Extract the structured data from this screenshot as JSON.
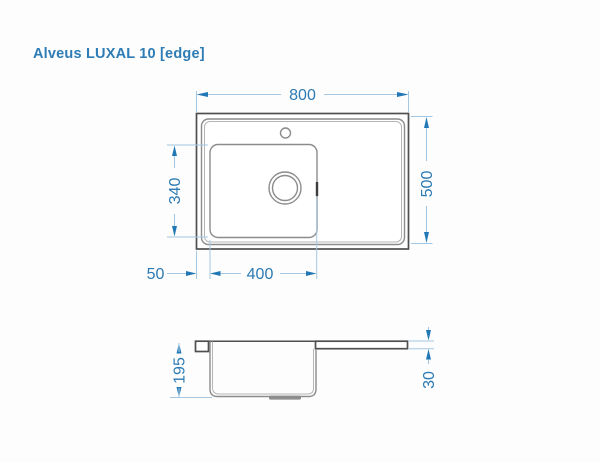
{
  "title": "Alveus LUXAL 10 [edge]",
  "drawing": {
    "product": "kitchen sink technical drawing",
    "views": {
      "top": "top view",
      "side": "side profile view"
    },
    "dimensions": {
      "overall_width": "800",
      "overall_depth": "500",
      "basin_width": "400",
      "basin_depth": "340",
      "basin_left_offset": "50",
      "bowl_depth": "195",
      "edge_thickness": "30"
    },
    "features": [
      "tap-hole",
      "drain",
      "overflow-mark",
      "drain-boss"
    ],
    "colors": {
      "title_blue": "#2d7cb5",
      "dimension_text_blue": "#2b7ab3",
      "arrow_blue": "#2278b5",
      "extension_line_blue": "#a4c8e4",
      "outline_dark_gray": "#4f4f4f",
      "outline_mid_gray": "#8c8c8c",
      "background": "#fdfdfd"
    }
  }
}
